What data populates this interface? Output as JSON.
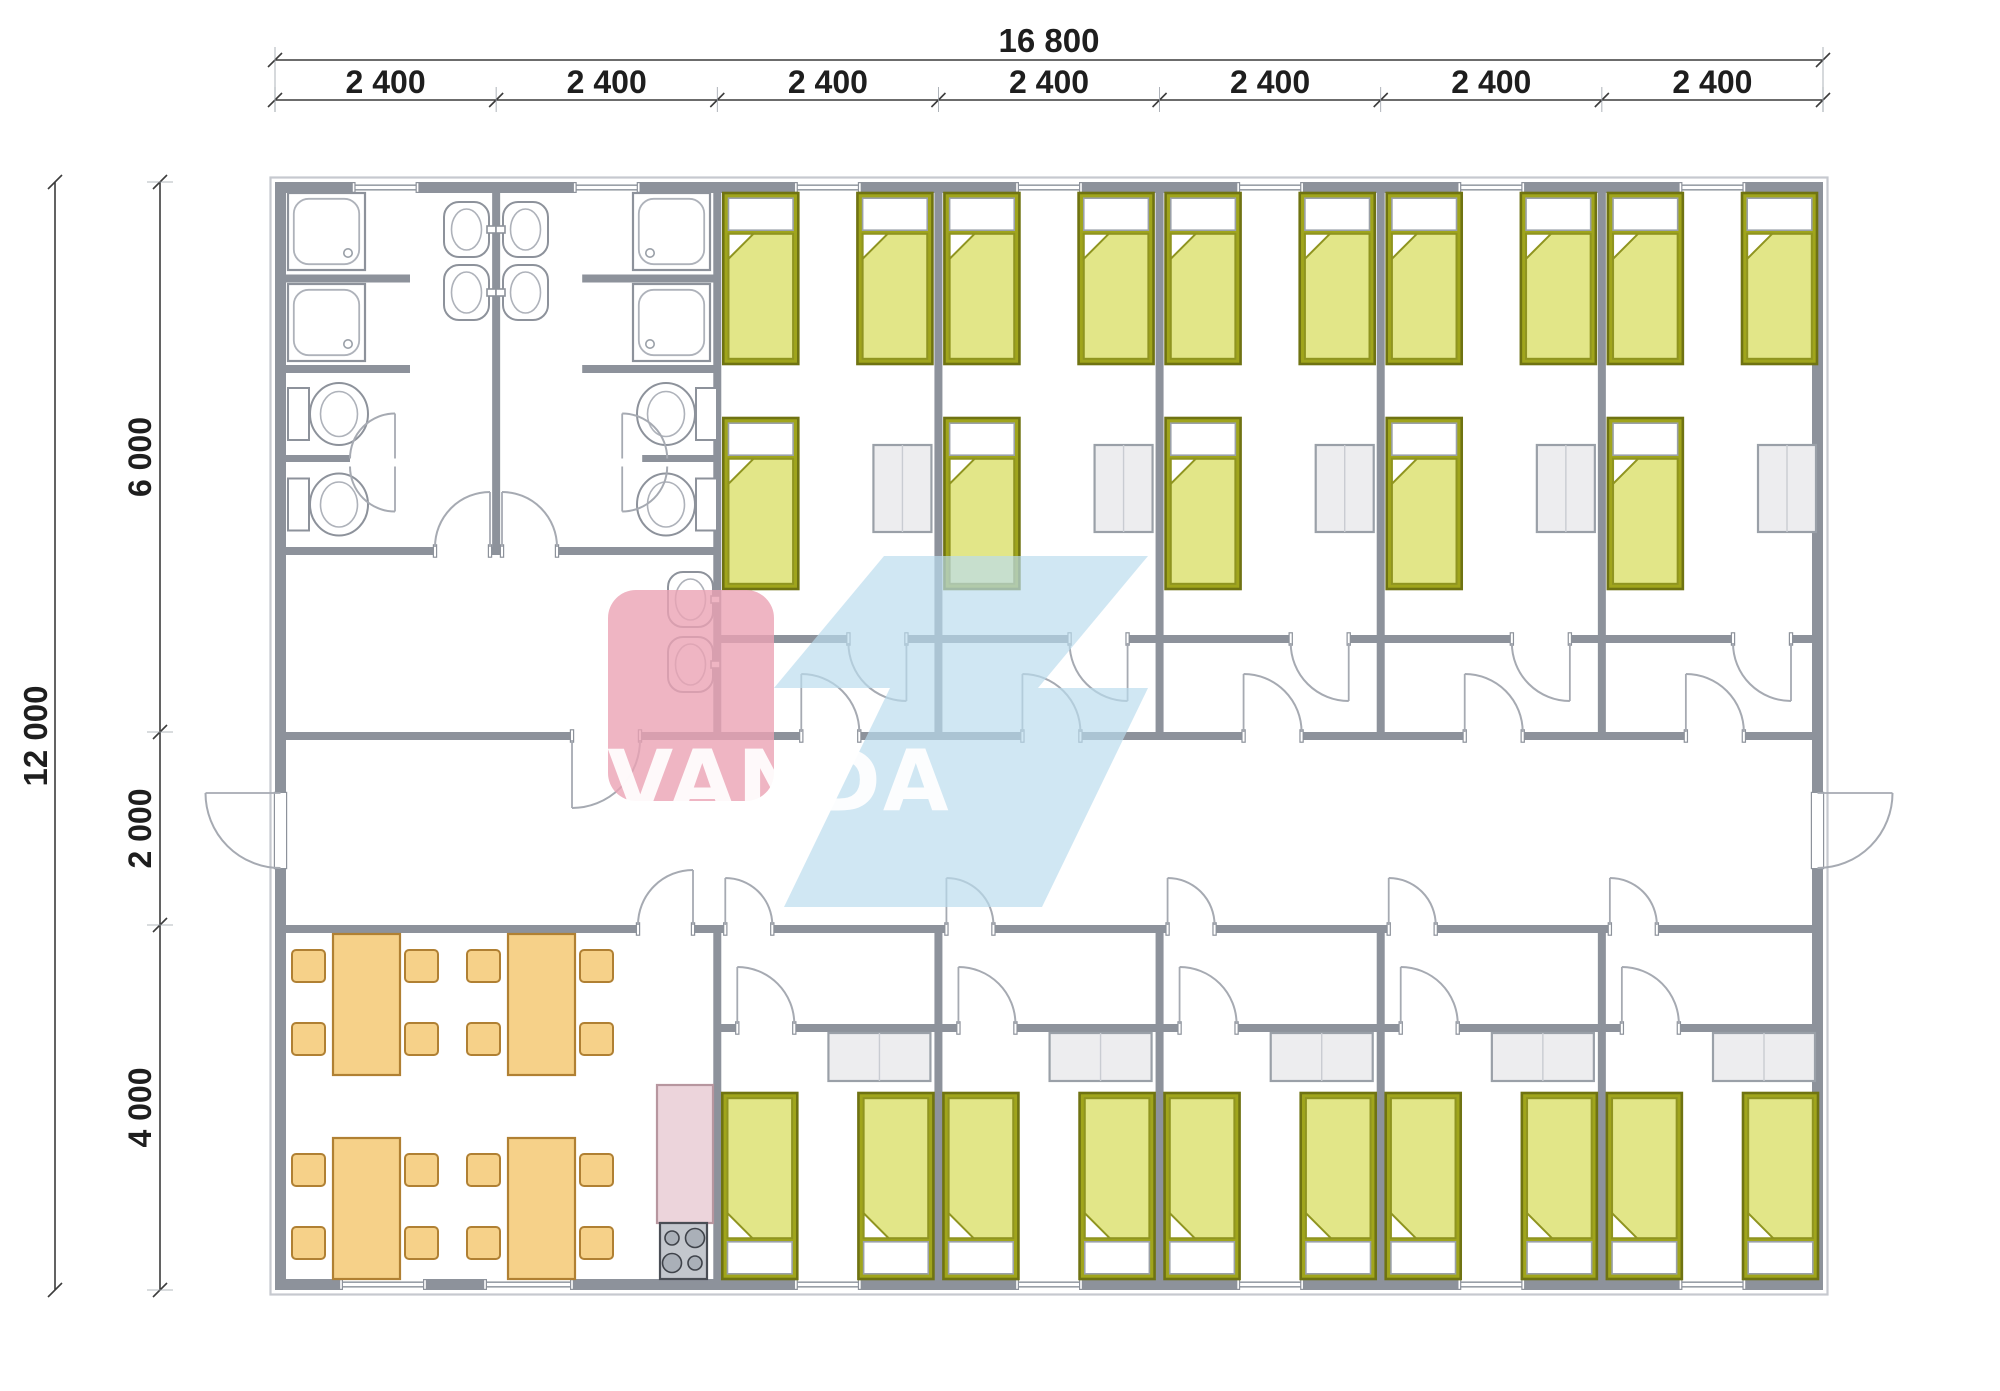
{
  "meta": {
    "drawing_type": "architectural floor plan",
    "building": "modular dormitory / accommodation container building",
    "brand": "VANDA"
  },
  "watermark": {
    "text": "VANDA",
    "pink": "#eba2b4",
    "blue": "#b9dcee",
    "letters": "#ffffff"
  },
  "dimensions": {
    "overall_width": "16 800",
    "module": "2 400",
    "module_count": 7,
    "overall_depth": "12 000",
    "top_depth": "6 000",
    "corridor_depth": "2 000",
    "bottom_depth": "4 000"
  },
  "rooms": {
    "bathrooms": {
      "count": 2,
      "each": {
        "showers": 2,
        "wash_basins": 2,
        "toilets": 2
      }
    },
    "washroom": {
      "count": 1,
      "wash_basins": 2
    },
    "top_bedrooms": {
      "count": 5,
      "each": {
        "beds": 3,
        "cabinet": 1
      }
    },
    "bottom_bedrooms": {
      "count": 5,
      "each": {
        "beds": 2,
        "cabinet": 1
      }
    },
    "corridor": {
      "exterior_doors": 2
    },
    "dining_room": {
      "tables": 4,
      "chairs": 16
    },
    "kitchen": {
      "counter": 1,
      "stove_burners": 4
    }
  },
  "totals": {
    "beds": 25,
    "showers": 4,
    "toilets": 4,
    "wash_basins": 6,
    "tables": 4,
    "chairs": 16,
    "cabinets": 10
  },
  "colors": {
    "wall": "#8d929b",
    "bed_frame": "#a0a51c",
    "bed_blanket": "#e2e688",
    "dining_furniture": "#f6d189",
    "dining_border": "#b08033",
    "kitchen_counter": "#ecd4db",
    "stove": "#c3c7cd",
    "cabinet": "#ededef",
    "door_arc": "#a6aab2",
    "dimension_text": "#1e1e1e"
  }
}
